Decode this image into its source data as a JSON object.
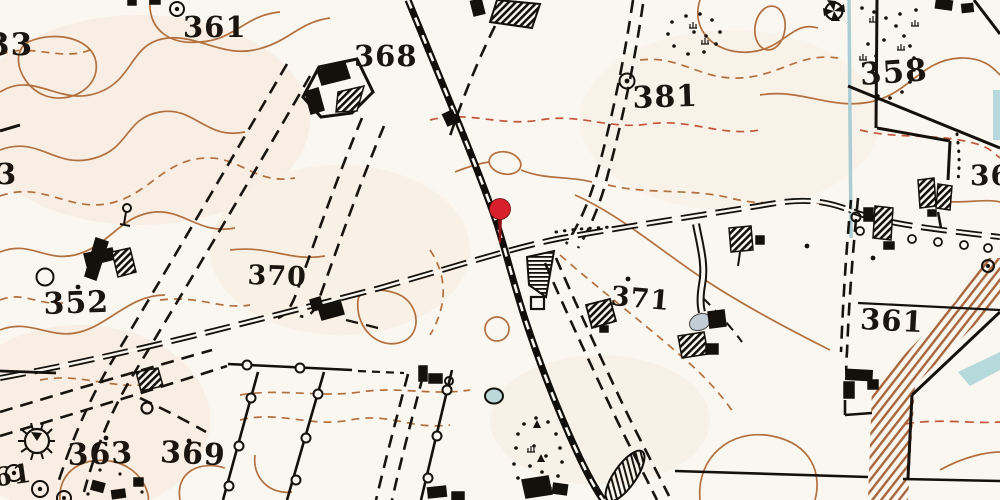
{
  "map": {
    "type": "historical-topographic-map",
    "elevation_labels": [
      "33",
      "361",
      "3",
      "368",
      "381",
      "358",
      "36",
      "352",
      "370",
      "371",
      "361",
      "363",
      "369",
      "61"
    ],
    "marker": {
      "name": "red-location-pin",
      "color": "#d7202b"
    },
    "palette": {
      "paper": "#faf7f1",
      "contour_brown": "#b2703f",
      "contour_red": "#c2563a",
      "ink": "#17140f",
      "water_blue": "#a9cdd3",
      "slope_hatch_sepia": "#a8653c"
    }
  }
}
